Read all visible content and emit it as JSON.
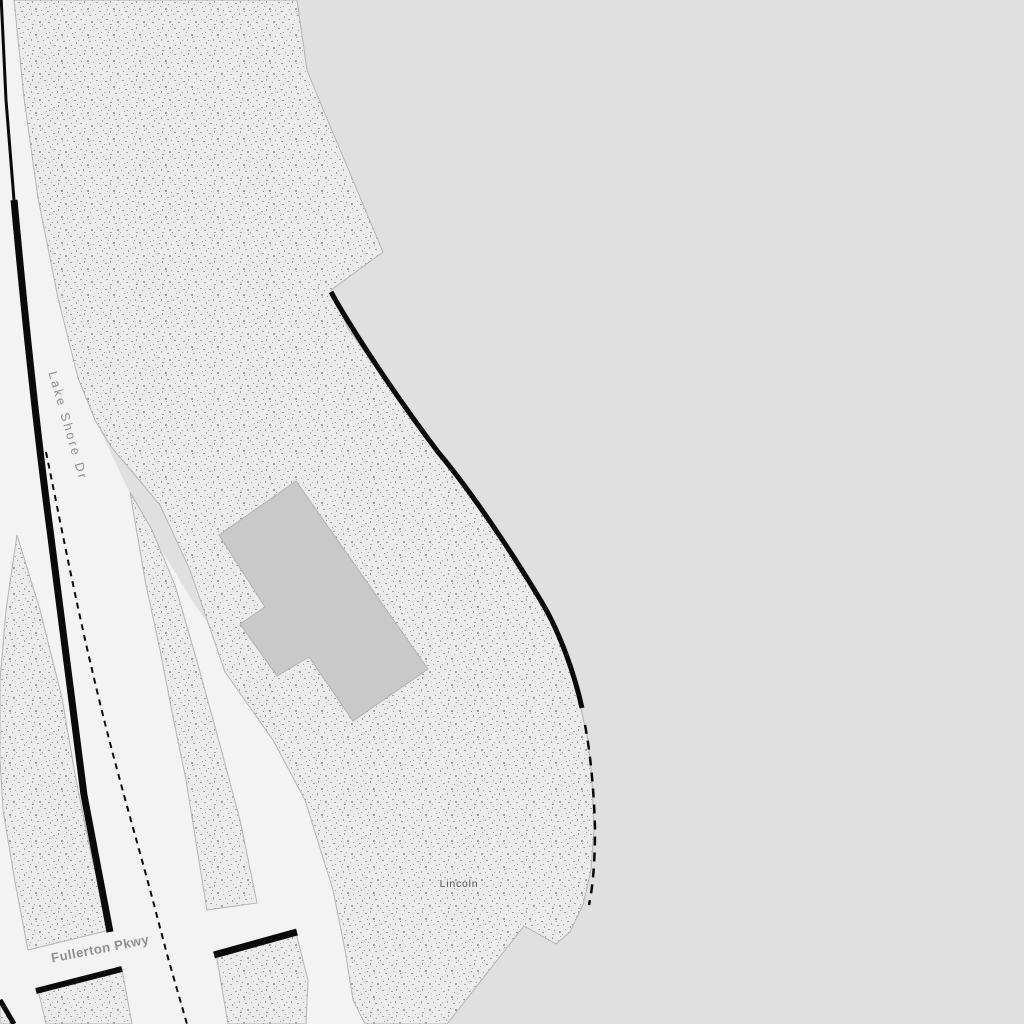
{
  "labels": {
    "lake_shore_dr": "Lake Shore Dr",
    "fullerton_pkwy": "Fullerton Pkwy",
    "lincoln": "Lincoln"
  },
  "colors": {
    "water": "#e0e0e0",
    "road": "#f3f3f3",
    "park_base": "#ebebeb",
    "park_dot": "#a3a3a3",
    "casing": "#b4b4b4",
    "building": "#c9c9c9",
    "building_casing": "#b2b2b2",
    "line_black": "#0a0a0a",
    "road_label": "#8f8f8f",
    "place_label": "#4f4f4f",
    "halo": "#f3f3f3"
  }
}
